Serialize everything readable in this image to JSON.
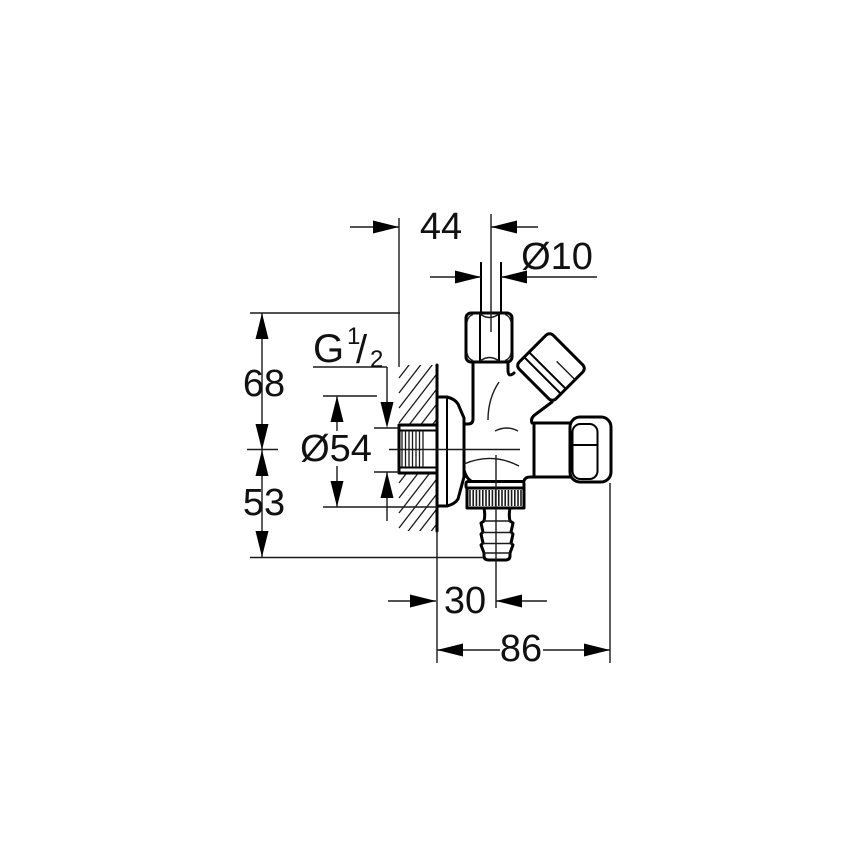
{
  "title": "Angle valve technical dimension drawing",
  "colors": {
    "background": "#ffffff",
    "line": "#000000",
    "text": "#111111"
  },
  "dimensions": {
    "top_width": "44",
    "pipe_diameter": "Ø10",
    "upper_height": "68",
    "lower_height": "53",
    "flange_diameter": "Ø54",
    "bottom_offset": "30",
    "total_depth": "86",
    "thread": {
      "prefix": "G",
      "numerator": "1",
      "slash": "/",
      "denominator": "2"
    }
  }
}
